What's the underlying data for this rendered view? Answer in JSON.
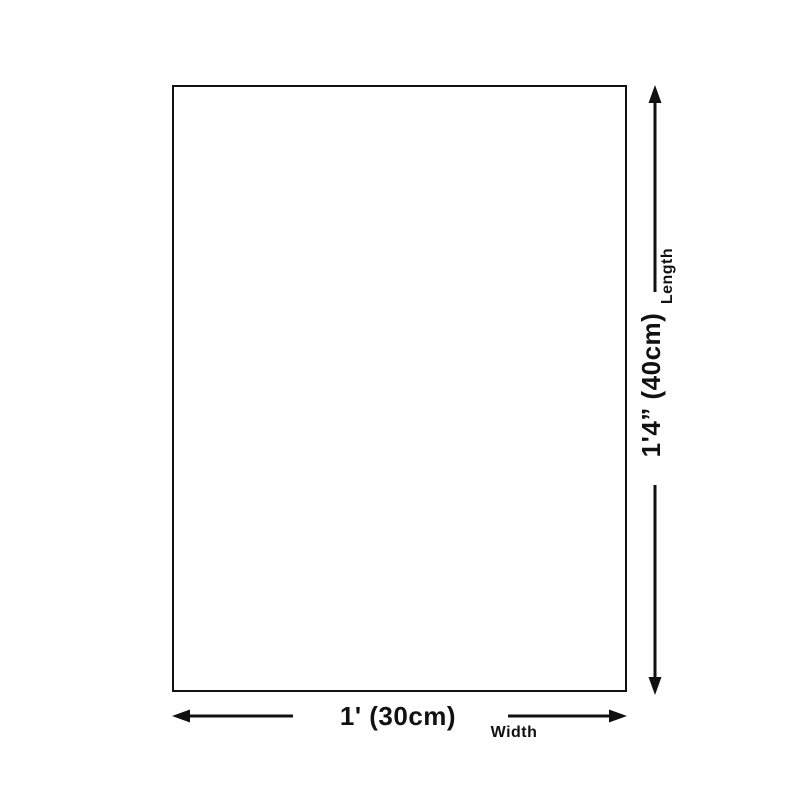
{
  "page": {
    "background_color": "#ffffff",
    "line_color": "#111111"
  },
  "length_dimension": {
    "label": "Length",
    "value": "1'4” (40cm)"
  },
  "width_dimension": {
    "label": "Width",
    "value": "1' (30cm)"
  }
}
